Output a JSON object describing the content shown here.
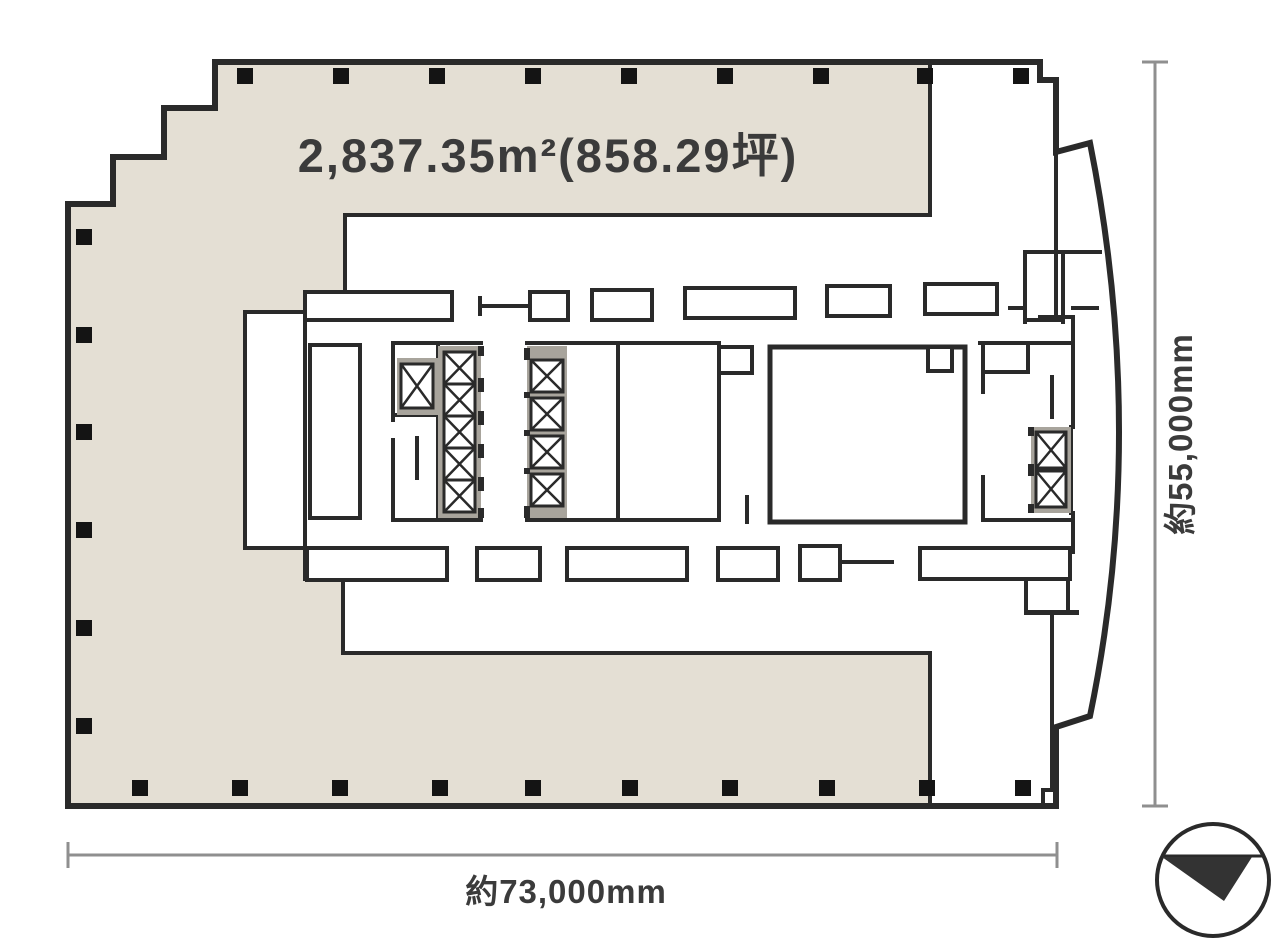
{
  "plan": {
    "area_label": "2,837.35m²(858.29坪)",
    "width_dimension": "約73,000mm",
    "height_dimension": "約55,000mm"
  },
  "colors": {
    "background": "#ffffff",
    "floor_fill": "#e4dfd4",
    "wall": "#2a2a2a",
    "elevator_hatch": "#a8a49c",
    "column": "#141414",
    "dimension_line": "#8f8f8f",
    "text": "#3b3b3b",
    "compass": "#333333"
  },
  "icons": {
    "elevator": "elevator-shaft-x-icon",
    "compass": "north-arrow-compass-icon",
    "column": "structural-column-marker"
  }
}
